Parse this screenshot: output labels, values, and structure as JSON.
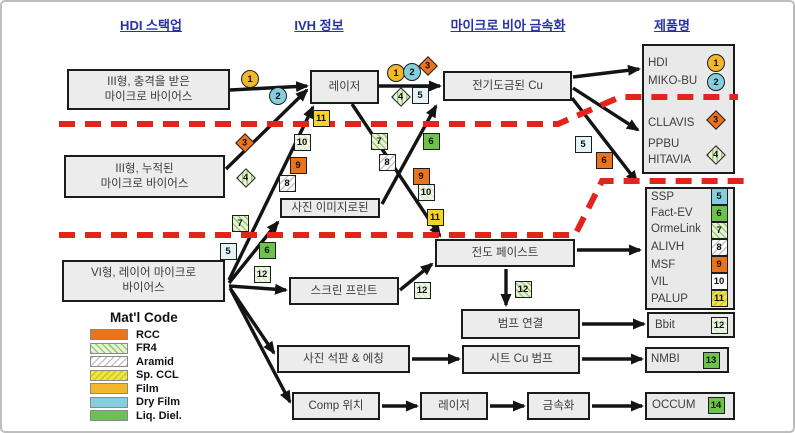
{
  "headers": [
    {
      "id": "hdi-stackup",
      "label": "HDI 스택업"
    },
    {
      "id": "ivh-info",
      "label": "IVH 정보"
    },
    {
      "id": "microvia-metallization",
      "label": "마이크로 비아 금속화"
    },
    {
      "id": "product-name",
      "label": "제품명"
    }
  ],
  "colors": {
    "header_blue": "#2832A4",
    "red_divider": "#E2241C",
    "box_fill": "#ECECEC",
    "rcc": "#E8741E",
    "fr4": "#E7F3DA",
    "aramid": "#FFFFFF",
    "spccl": "#EDE93C",
    "film": "#F2B72B",
    "dryfilm": "#85CEDD",
    "liqdiel": "#6CC24A"
  },
  "boxes": [
    {
      "id": "type3-staggered-microvias",
      "x": 65,
      "y": 67,
      "w": 163,
      "h": 41,
      "label": "III형, 충격을 받은\n마이크로 바이어스"
    },
    {
      "id": "type3-stacked-microvias",
      "x": 62,
      "y": 153,
      "w": 161,
      "h": 43,
      "label": "III형, 누적된\n마이크로 바이어스"
    },
    {
      "id": "type6-layer-microvias",
      "x": 60,
      "y": 258,
      "w": 163,
      "h": 42,
      "label": "VI형, 레이어 마이크로\n바이어스"
    },
    {
      "id": "laser-1",
      "x": 308,
      "y": 68,
      "w": 69,
      "h": 34,
      "label": "레이저"
    },
    {
      "id": "electroplated-cu",
      "x": 441,
      "y": 69,
      "w": 129,
      "h": 30,
      "label": "전기도금된 Cu"
    },
    {
      "id": "photo-imaged",
      "x": 278,
      "y": 196,
      "w": 100,
      "h": 20,
      "label": "사진 이미지로된"
    },
    {
      "id": "screen-print",
      "x": 287,
      "y": 275,
      "w": 110,
      "h": 28,
      "label": "스크린 프린트"
    },
    {
      "id": "conductive-paste",
      "x": 433,
      "y": 237,
      "w": 140,
      "h": 28,
      "label": "전도 페이스트"
    },
    {
      "id": "bump-connection",
      "x": 459,
      "y": 307,
      "w": 119,
      "h": 30,
      "label": "범프 연결"
    },
    {
      "id": "photo-litho-etching",
      "x": 275,
      "y": 343,
      "w": 133,
      "h": 28,
      "label": "사진 석판 & 에칭"
    },
    {
      "id": "sheet-cu-bump",
      "x": 460,
      "y": 343,
      "w": 118,
      "h": 29,
      "label": "시트 Cu 범프"
    },
    {
      "id": "comp-placement",
      "x": 290,
      "y": 390,
      "w": 88,
      "h": 28,
      "label": "Comp 위치"
    },
    {
      "id": "laser-2",
      "x": 418,
      "y": 390,
      "w": 68,
      "h": 28,
      "label": "레이저"
    },
    {
      "id": "metallization",
      "x": 525,
      "y": 390,
      "w": 63,
      "h": 28,
      "label": "금속화"
    }
  ],
  "panels": [
    {
      "id": "products-top",
      "x": 640,
      "y": 42,
      "w": 93,
      "h": 130
    },
    {
      "id": "products-middle",
      "x": 643,
      "y": 185,
      "w": 90,
      "h": 123
    },
    {
      "id": "products-bbit",
      "x": 645,
      "y": 310,
      "w": 88,
      "h": 26
    },
    {
      "id": "products-nmbi",
      "x": 643,
      "y": 345,
      "w": 84,
      "h": 26
    },
    {
      "id": "products-occum",
      "x": 643,
      "y": 390,
      "w": 90,
      "h": 28
    }
  ],
  "products": [
    {
      "id": "hdi",
      "label": "HDI",
      "x": 646,
      "y": 62
    },
    {
      "id": "miko-bu",
      "label": "MIKO-BU",
      "x": 646,
      "y": 80
    },
    {
      "id": "cllavis",
      "label": "CLLAVIS",
      "x": 646,
      "y": 122
    },
    {
      "id": "ppbu",
      "label": "PPBU",
      "x": 646,
      "y": 143
    },
    {
      "id": "hitavia",
      "label": "HITAVIA",
      "x": 646,
      "y": 159
    },
    {
      "id": "ssp",
      "label": "SSP",
      "x": 649,
      "y": 196
    },
    {
      "id": "fact-ev",
      "label": "Fact-EV",
      "x": 649,
      "y": 212
    },
    {
      "id": "ormelink",
      "label": "OrmeLink",
      "x": 649,
      "y": 228
    },
    {
      "id": "alivh",
      "label": "ALIVH",
      "x": 649,
      "y": 246
    },
    {
      "id": "msf",
      "label": "MSF",
      "x": 649,
      "y": 264
    },
    {
      "id": "vil",
      "label": "VIL",
      "x": 649,
      "y": 281
    },
    {
      "id": "palup",
      "label": "PALUP",
      "x": 649,
      "y": 298
    },
    {
      "id": "bbit",
      "label": "Bbit",
      "x": 653,
      "y": 324
    },
    {
      "id": "nmbi",
      "label": "NMBI",
      "x": 649,
      "y": 358
    },
    {
      "id": "occum",
      "label": "OCCUM",
      "x": 650,
      "y": 404
    }
  ],
  "badges": [
    {
      "num": 1,
      "shape": "circle",
      "fill": "film",
      "x": 248,
      "y": 77
    },
    {
      "num": 2,
      "shape": "circle",
      "fill": "dryfilm",
      "x": 276,
      "y": 94
    },
    {
      "num": 3,
      "shape": "diamond",
      "fill": "rcc",
      "x": 243,
      "y": 141
    },
    {
      "num": 4,
      "shape": "diamond",
      "fill": "fr4",
      "x": 244,
      "y": 176
    },
    {
      "num": 11,
      "shape": "square",
      "fill": "yellow",
      "x": 319,
      "y": 116
    },
    {
      "num": 10,
      "shape": "square",
      "fill": "fr4light",
      "x": 300,
      "y": 140
    },
    {
      "num": 9,
      "shape": "square",
      "fill": "rcc",
      "x": 296,
      "y": 163
    },
    {
      "num": 8,
      "shape": "square",
      "fill": "aramid",
      "x": 285,
      "y": 181
    },
    {
      "num": 7,
      "shape": "square",
      "fill": "fr4",
      "x": 238,
      "y": 221
    },
    {
      "num": 5,
      "shape": "square",
      "fill": "dryfilmlight",
      "x": 226,
      "y": 249
    },
    {
      "num": 6,
      "shape": "square",
      "fill": "liqdiel",
      "x": 265,
      "y": 248
    },
    {
      "num": 12,
      "shape": "square",
      "fill": "fr4light",
      "x": 260,
      "y": 272
    },
    {
      "num": 1,
      "shape": "circle",
      "fill": "film",
      "x": 394,
      "y": 71
    },
    {
      "num": 2,
      "shape": "circle",
      "fill": "dryfilm",
      "x": 410,
      "y": 70
    },
    {
      "num": 3,
      "shape": "diamond",
      "fill": "rcc",
      "x": 426,
      "y": 64
    },
    {
      "num": 4,
      "shape": "diamond",
      "fill": "fr4",
      "x": 399,
      "y": 95
    },
    {
      "num": 5,
      "shape": "square",
      "fill": "dryfilmlight",
      "x": 418,
      "y": 93
    },
    {
      "num": 7,
      "shape": "square",
      "fill": "fr4",
      "x": 377,
      "y": 139
    },
    {
      "num": 8,
      "shape": "square",
      "fill": "aramid",
      "x": 385,
      "y": 160
    },
    {
      "num": 9,
      "shape": "square",
      "fill": "rcc",
      "x": 419,
      "y": 174
    },
    {
      "num": 10,
      "shape": "square",
      "fill": "fr4light",
      "x": 424,
      "y": 190
    },
    {
      "num": 11,
      "shape": "square",
      "fill": "yellow",
      "x": 433,
      "y": 215
    },
    {
      "num": 6,
      "shape": "square",
      "fill": "liqdiel",
      "x": 429,
      "y": 139
    },
    {
      "num": 5,
      "shape": "square",
      "fill": "dryfilmlight",
      "x": 581,
      "y": 142
    },
    {
      "num": 6,
      "shape": "square",
      "fill": "rcc",
      "x": 602,
      "y": 158
    },
    {
      "num": 12,
      "shape": "square",
      "fill": "fr4light",
      "x": 420,
      "y": 288
    },
    {
      "num": 12,
      "shape": "square",
      "fill": "fr4",
      "x": 521,
      "y": 287
    },
    {
      "num": 1,
      "shape": "circle",
      "fill": "film",
      "x": 714,
      "y": 61
    },
    {
      "num": 2,
      "shape": "circle",
      "fill": "dryfilm",
      "x": 714,
      "y": 80
    },
    {
      "num": 3,
      "shape": "diamond",
      "fill": "rcc",
      "x": 714,
      "y": 118
    },
    {
      "num": 4,
      "shape": "diamond",
      "fill": "fr4",
      "x": 714,
      "y": 153
    },
    {
      "num": 5,
      "shape": "square",
      "fill": "dryfilm",
      "x": 717,
      "y": 194
    },
    {
      "num": 6,
      "shape": "square",
      "fill": "liqdiel",
      "x": 717,
      "y": 211
    },
    {
      "num": 7,
      "shape": "square",
      "fill": "fr4",
      "x": 717,
      "y": 228
    },
    {
      "num": 8,
      "shape": "square",
      "fill": "aramid",
      "x": 717,
      "y": 245
    },
    {
      "num": 9,
      "shape": "square",
      "fill": "rcc",
      "x": 717,
      "y": 262
    },
    {
      "num": 10,
      "shape": "square",
      "fill": "white",
      "x": 717,
      "y": 279
    },
    {
      "num": 11,
      "shape": "square",
      "fill": "spccl",
      "x": 717,
      "y": 296
    },
    {
      "num": 12,
      "shape": "square",
      "fill": "fr4light",
      "x": 717,
      "y": 323
    },
    {
      "num": 13,
      "shape": "square",
      "fill": "liqdiel",
      "x": 709,
      "y": 358
    },
    {
      "num": 14,
      "shape": "square",
      "fill": "liqdiel",
      "x": 714,
      "y": 403
    }
  ],
  "edges": [
    [
      228,
      88,
      305,
      84
    ],
    [
      224,
      167,
      305,
      88
    ],
    [
      227,
      278,
      311,
      105
    ],
    [
      227,
      281,
      276,
      220
    ],
    [
      227,
      284,
      284,
      288
    ],
    [
      228,
      286,
      272,
      351
    ],
    [
      229,
      288,
      288,
      400
    ],
    [
      377,
      84,
      438,
      84
    ],
    [
      350,
      102,
      438,
      234
    ],
    [
      380,
      202,
      434,
      104
    ],
    [
      398,
      288,
      430,
      262
    ],
    [
      571,
      75,
      637,
      67
    ],
    [
      571,
      86,
      636,
      128
    ],
    [
      570,
      96,
      635,
      180
    ],
    [
      575,
      248,
      638,
      248
    ],
    [
      504,
      267,
      504,
      303
    ],
    [
      580,
      322,
      642,
      322
    ],
    [
      410,
      357,
      457,
      357
    ],
    [
      580,
      357,
      640,
      357
    ],
    [
      380,
      404,
      415,
      404
    ],
    [
      488,
      404,
      522,
      404
    ],
    [
      590,
      404,
      640,
      404
    ]
  ],
  "red_lines": [
    [
      57,
      122,
      556,
      122,
      618,
      95,
      736,
      95
    ],
    [
      57,
      233,
      573,
      233,
      600,
      179,
      742,
      179
    ]
  ],
  "legend": {
    "title": "Mat'l Code",
    "items": [
      {
        "label": "RCC",
        "fill": "rcc"
      },
      {
        "label": "FR4",
        "fill": "fr4"
      },
      {
        "label": "Aramid",
        "fill": "aramid"
      },
      {
        "label": "Sp. CCL",
        "fill": "spccl"
      },
      {
        "label": "Film",
        "fill": "film"
      },
      {
        "label": "Dry Film",
        "fill": "dryfilm"
      },
      {
        "label": "Liq. Diel.",
        "fill": "liqdiel"
      }
    ]
  }
}
